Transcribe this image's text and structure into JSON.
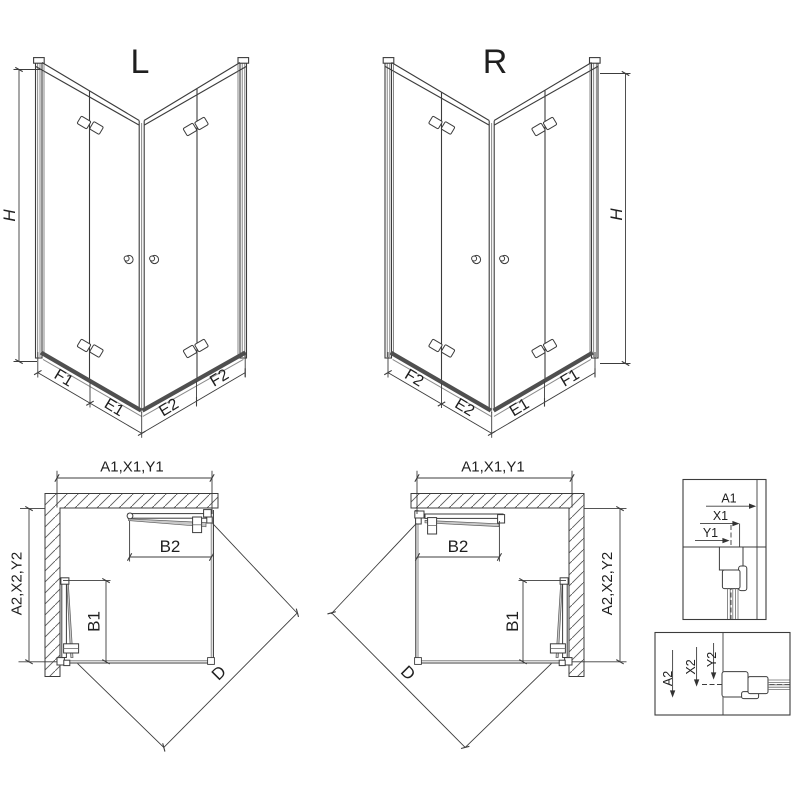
{
  "style": {
    "line_color": "#3c3c3c",
    "rail_color": "#4f4f4f",
    "glass_fill": "#c9c9c9"
  },
  "iso_left": {
    "title": "L",
    "height_label": "H",
    "segments": [
      "F1",
      "E1",
      "E2",
      "F2"
    ]
  },
  "iso_right": {
    "title": "R",
    "height_label": "H",
    "segments": [
      "F2",
      "E2",
      "E1",
      "F1"
    ]
  },
  "plan_left": {
    "top_dim": "A1,X1,Y1",
    "side_dim": "A2,X2,Y2",
    "door_top_dim": "B2",
    "door_side_dim": "B1",
    "diagonal_dim": "D"
  },
  "plan_right": {
    "top_dim": "A1,X1,Y1",
    "side_dim": "A2,X2,Y2",
    "door_top_dim": "B2",
    "door_side_dim": "B1",
    "diagonal_dim": "D"
  },
  "detail_top": {
    "dims": [
      "A1",
      "X1",
      "Y1"
    ]
  },
  "detail_bottom": {
    "dims": [
      "A2",
      "X2",
      "Y2"
    ]
  }
}
